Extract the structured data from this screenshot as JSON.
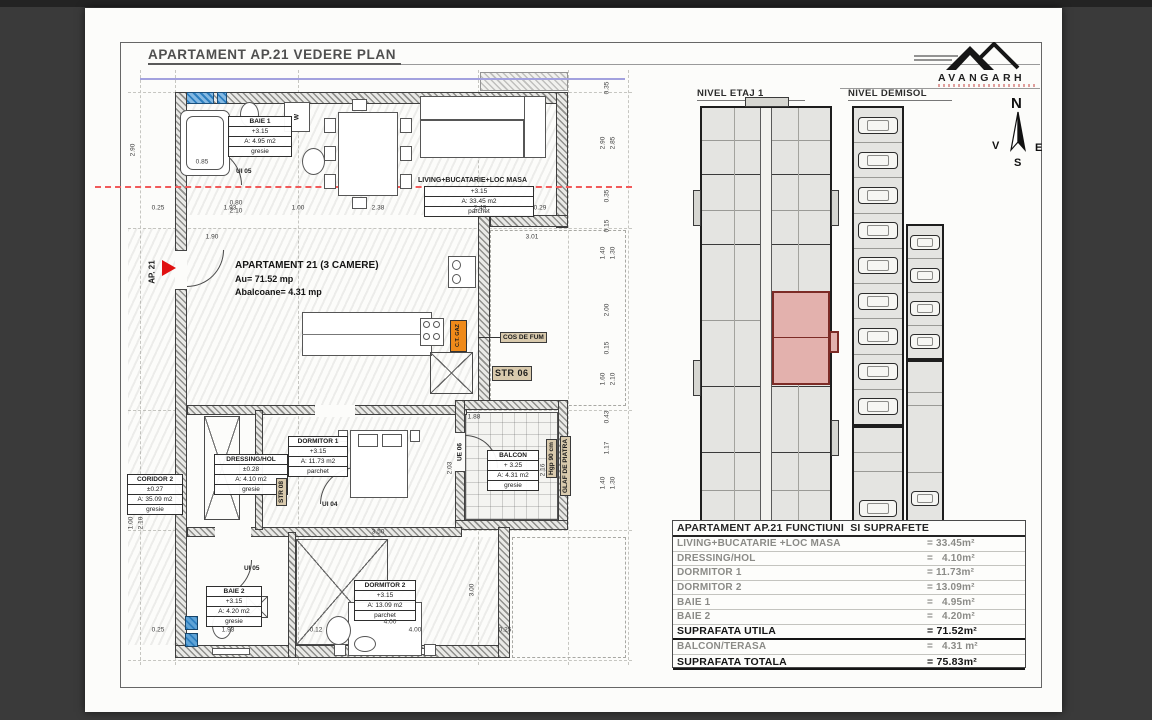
{
  "title": "APARTAMENT AP.21 VEDERE PLAN",
  "logo": {
    "name": "AVANGARH"
  },
  "compass": {
    "n": "N",
    "s": "S",
    "e": "E",
    "v": "V"
  },
  "plans": {
    "etaj1": "NIVEL ETAJ 1",
    "demisol": "NIVEL DEMISOL"
  },
  "info": {
    "title": "APARTAMENT 21 (3 CAMERE)",
    "au": "Au= 71.52 mp",
    "abalcoane": "Abalcoane= 4.31 mp",
    "marker": "AP. 21"
  },
  "rooms": {
    "baie1": {
      "name": "BAIE 1",
      "level": "+3.15",
      "area": "A: 4.95 m2",
      "finish": "gresie"
    },
    "living": {
      "name": "LIVING+BUCATARIE+LOC MASA",
      "level": "+3.15",
      "area": "A: 33.45 m2",
      "finish": "parchet"
    },
    "dormitor1": {
      "name": "DORMITOR 1",
      "level": "+3.15",
      "area": "A: 11.73 m2",
      "finish": "parchet"
    },
    "dormitor2": {
      "name": "DORMITOR 2",
      "level": "+3.15",
      "area": "A: 13.09 m2",
      "finish": "parchet"
    },
    "baie2": {
      "name": "BAIE 2",
      "level": "+3.15",
      "area": "A: 4.20 m2",
      "finish": "gresie"
    },
    "dressing": {
      "name": "DRESSING/HOL",
      "level": "±0.28",
      "area": "A: 4.10 m2",
      "finish": "gresie"
    },
    "coridor2": {
      "name": "CORIDOR 2",
      "level": "±0.27",
      "area": "A: 35.09 m2",
      "finish": "gresie"
    },
    "balcon": {
      "name": "BALCON",
      "level": "+ 3.25",
      "area": "A: 4.31 m2",
      "finish": "gresie"
    }
  },
  "labels": {
    "ct_gaz": "C.T. GAZ",
    "cos_de_fum": "COS DE FUM",
    "str06": "STR 06",
    "str08": "STR 08",
    "ui04": "UI 04",
    "ui05": "UI 05",
    "ue06": "UE 06",
    "hgp": "Hgp 90 cm",
    "glaf": "GLAF DE PIATRA",
    "w": "W"
  },
  "dims": {
    "top": [
      "0.25",
      "1.93",
      "1.00",
      "2.38",
      "2.49",
      "0.29"
    ],
    "bottom": [
      "0.25",
      "1.93",
      "0.12",
      "4.00",
      "0.25"
    ],
    "right": [
      "0.35",
      "2.90",
      "2.85",
      "0.35",
      "0.15",
      "1.40",
      "1.30",
      "2.00",
      "0.15",
      "1.60",
      "2.10",
      "0.43",
      "1.17",
      "1.40",
      "1.30"
    ],
    "left": [
      "2.90",
      "1.00",
      "2.10"
    ],
    "inner": [
      "1.90",
      "3.01",
      "0.80",
      "2.10",
      "3.50",
      "2.03",
      "1.88",
      "2.16",
      "4.00",
      "3.00",
      "0.85"
    ]
  },
  "table": {
    "title": "APARTAMENT AP.21 FUNCTIUNI  SI SUPRAFETE",
    "rows": [
      {
        "label": "LIVING+BUCATARIE +LOC MASA",
        "value": "= 33.45m²"
      },
      {
        "label": "DRESSING/HOL",
        "value": "=   4.10m²"
      },
      {
        "label": "DORMITOR 1",
        "value": "= 11.73m²"
      },
      {
        "label": "DORMITOR 2",
        "value": "= 13.09m²"
      },
      {
        "label": "BAIE 1",
        "value": "=   4.95m²"
      },
      {
        "label": "BAIE 2",
        "value": "=   4.20m²"
      },
      {
        "label": "SUPRAFATA UTILA",
        "value": "= 71.52m²"
      },
      {
        "label": "BALCON/TERASA",
        "value": "=   4.31 m²"
      },
      {
        "label": "SUPRAFATA TOTALA",
        "value": "= 75.83m²"
      }
    ]
  },
  "colors": {
    "highlight": "#e3b1ad",
    "section_line": "#f15a5a",
    "ct_gaz": "#ef8a1a",
    "window_blue": "#2d7fc0"
  }
}
